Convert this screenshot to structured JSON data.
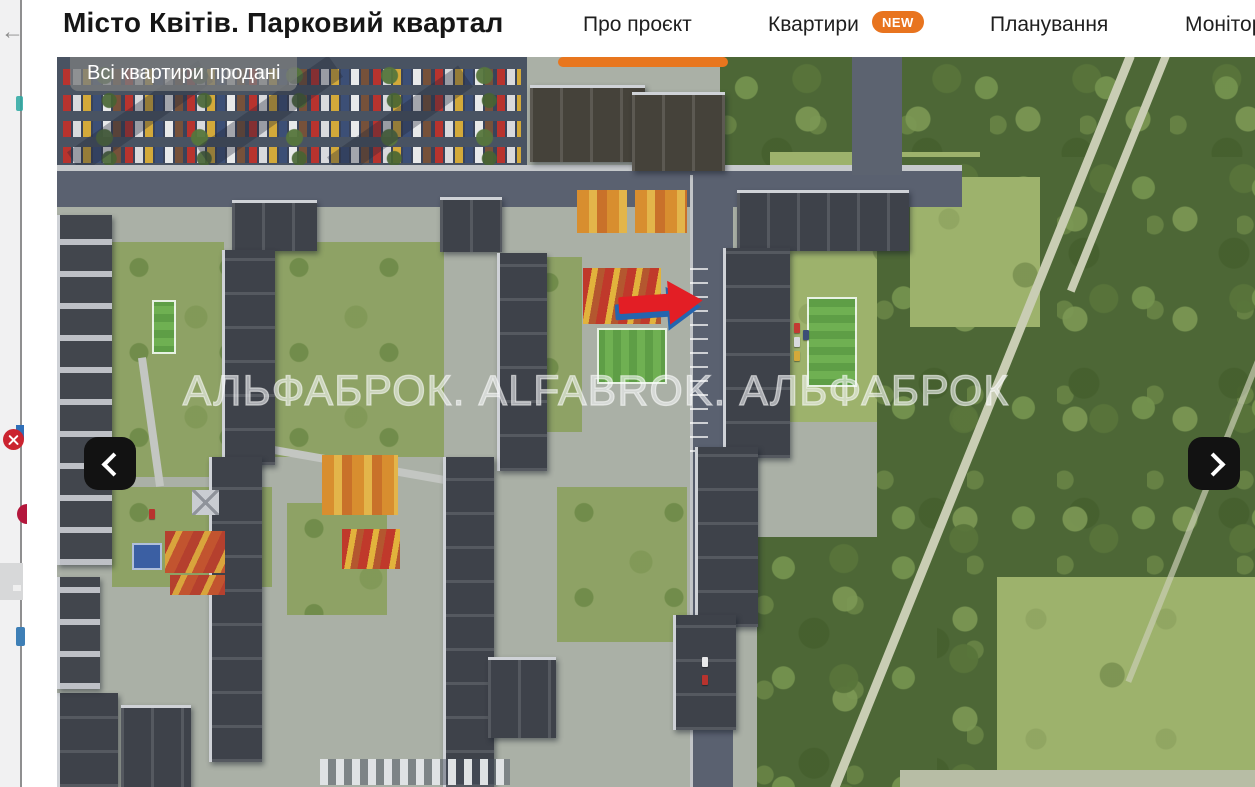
{
  "left_panel": {
    "back_icon": "←"
  },
  "header": {
    "title": "Місто Квітів. Парковий квартал",
    "nav": [
      {
        "label": "Про проєкт",
        "active": true
      },
      {
        "label": "Квартири",
        "badge": "NEW",
        "active": false
      },
      {
        "label": "Планування",
        "active": false
      },
      {
        "label": "Моніторинг",
        "active": false
      }
    ],
    "accent_color": "#e8761e"
  },
  "gallery": {
    "sold_badge": "Всі квартири продані",
    "watermark": "АЛЬФАБРОК. ALFABROK. АЛЬФАБРОК",
    "sold_badge_bg": "rgba(122,124,126,0.78)",
    "annotation_arrow_color": "#e31e25"
  }
}
